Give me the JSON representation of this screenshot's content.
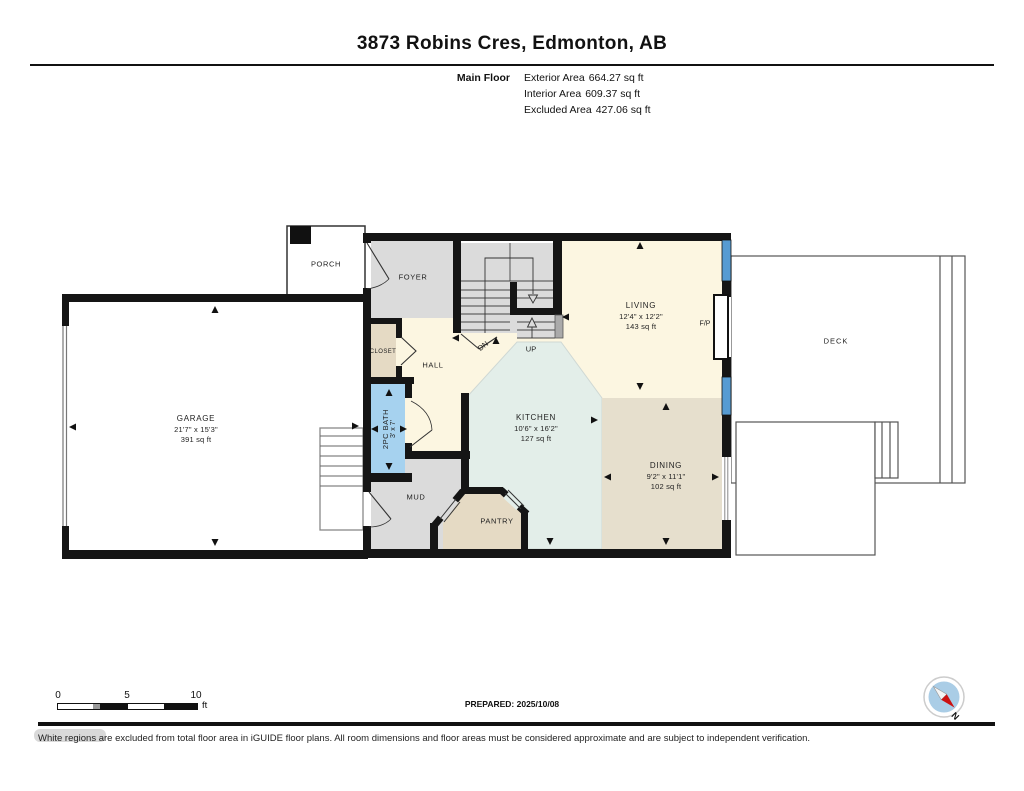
{
  "header": {
    "title": "3873 Robins Cres, Edmonton, AB",
    "floor_label": "Main Floor",
    "stats": [
      {
        "label": "Exterior Area",
        "value": "664.27 sq ft"
      },
      {
        "label": "Interior Area",
        "value": "609.37 sq ft"
      },
      {
        "label": "Excluded Area",
        "value": "427.06 sq ft"
      }
    ]
  },
  "rooms": {
    "porch": {
      "name": "PORCH"
    },
    "foyer": {
      "name": "FOYER"
    },
    "living": {
      "name": "LIVING",
      "dims": "12'4\" x 12'2\"",
      "area": "143 sq ft"
    },
    "garage": {
      "name": "GARAGE",
      "dims": "21'7\" x 15'3\"",
      "area": "391 sq ft"
    },
    "closet": {
      "name": "CLOSET"
    },
    "hall": {
      "name": "HALL"
    },
    "bath": {
      "name": "2PC BATH",
      "dims": "3' x 7'"
    },
    "kitchen": {
      "name": "KITCHEN",
      "dims": "10'6\" x 16'2\"",
      "area": "127 sq ft"
    },
    "dining": {
      "name": "DINING",
      "dims": "9'2\" x 11'1\"",
      "area": "102 sq ft"
    },
    "mud": {
      "name": "MUD"
    },
    "pantry": {
      "name": "PANTRY"
    },
    "deck": {
      "name": "DECK"
    },
    "fireplace": {
      "name": "F/P"
    }
  },
  "stairs": {
    "up": "UP",
    "down": "DN"
  },
  "scale_bar": {
    "tick_0": "0",
    "tick_5": "5",
    "tick_10": "10",
    "unit": "ft"
  },
  "prepared": "PREPARED: 2025/10/08",
  "compass": {
    "north": "N"
  },
  "disclaimer": "White regions are excluded from total floor area in iGUIDE floor plans. All room dimensions and floor areas must be considered approximate and are subject to independent verification.",
  "colors": {
    "wall": "#151515",
    "living_cream": "#FCF6E1",
    "kitchen_teal": "#E3EEE9",
    "dining_tan": "#E6DFCD",
    "room_gray": "#DBDBDB",
    "closet_tan": "#E5DAC4",
    "bath_blue": "#A6D2EF",
    "window_blue": "#569BD2",
    "compass_blue": "#AACDE6",
    "compass_red": "#CC1111"
  }
}
